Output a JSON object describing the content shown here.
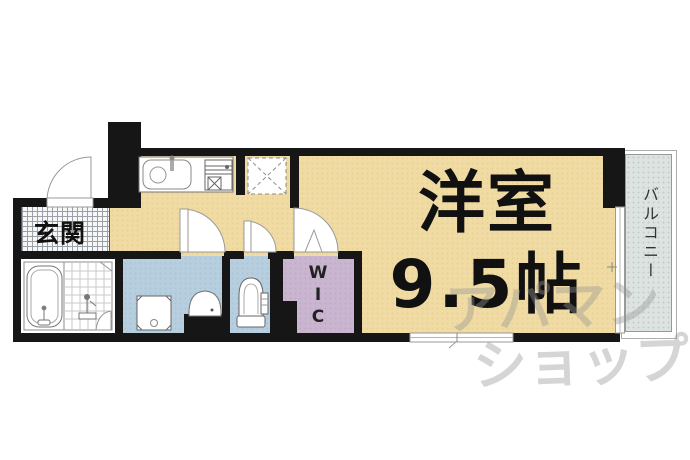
{
  "image_type": "apartment-floor-plan",
  "rooms": {
    "entrance": {
      "label": "玄関"
    },
    "main_room": {
      "name": "洋室",
      "size": "9.5帖"
    },
    "wic": {
      "label": "WIC"
    },
    "balcony": {
      "label": "バルコニー"
    }
  },
  "watermark": {
    "line1": "アパマン",
    "line2": "ショップ"
  },
  "colors": {
    "wall": "#161616",
    "room_floor": "#f0dba4",
    "wet_room_floor": "#b6cede",
    "wic_floor": "#c9b5cf",
    "balcony_floor": "#dde3e0",
    "entrance_hatch_line": "#9aa0a8",
    "fixture_stroke": "#888888",
    "watermark_gray": "#969696",
    "text": "#111111"
  }
}
